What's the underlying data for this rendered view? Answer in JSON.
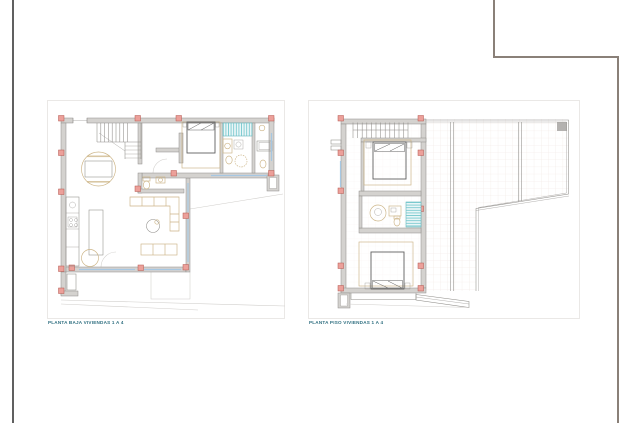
{
  "plans": [
    {
      "id": "ground-floor",
      "label": "PLANTA BAJA VIVIENDAS 1 A 4"
    },
    {
      "id": "first-floor",
      "label": "PLANTA PISO VIVIENDAS 1 A 4"
    }
  ],
  "colors": {
    "paper": "#ffffff",
    "rule": "#606060",
    "frame": "#8a8078",
    "box_border": "#eae8e6",
    "label": "#2f6f80",
    "wall": "#d4d2cf",
    "wall_edge": "#8f8d89",
    "column_fill": "#eca09a",
    "column_edge": "#b4574f",
    "tan": "#ccb486",
    "dark": "#606060",
    "blue": "#a6c7e2",
    "faint": "#d0cecb",
    "grid": "#f0e6e1",
    "cyan": "#6ec5cb",
    "cyan_bg": "#eaf6f7",
    "cyan_edge": "#5fb3ba",
    "shaft": "#b4b2b0"
  }
}
